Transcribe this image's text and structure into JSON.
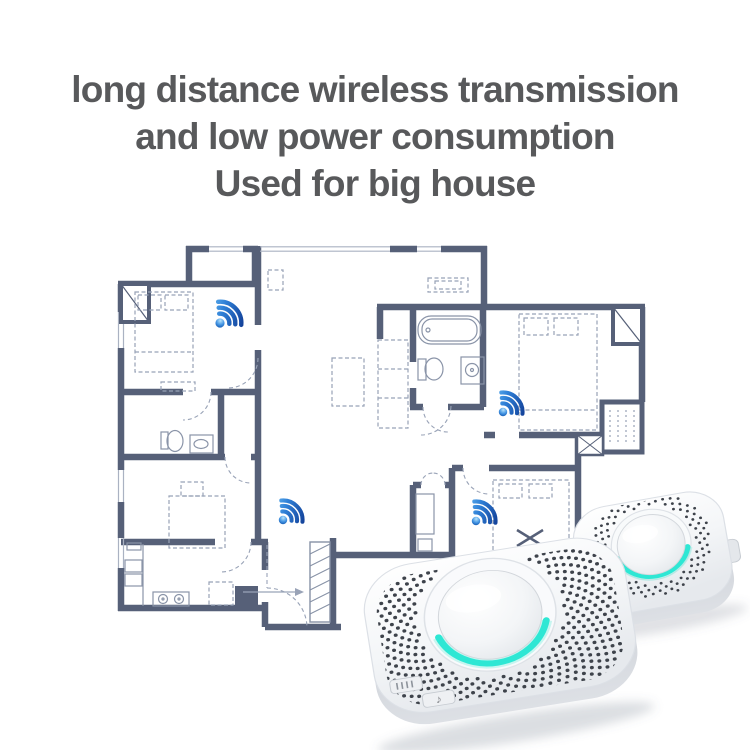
{
  "heading": {
    "line1": "long distance wireless transmission",
    "line2": "and low power consumption",
    "line3": "Used for big house"
  },
  "floorplan": {
    "wifi_marker_count": 4
  },
  "device_controls": {
    "music_note": "♪"
  },
  "palette": {
    "heading_text": "#58595b",
    "wall": "#566078",
    "floorplan_line": "#9aa3b7",
    "furniture_dash": "#98a2b6",
    "wifi_light_blue": "#6fc0f5",
    "wifi_dark_blue": "#123f97",
    "led_cyan": "#2ee7d4",
    "device_body_white": "#ffffff",
    "device_side_gray": "#c9ced5",
    "grille_dot": "#3e434b"
  }
}
